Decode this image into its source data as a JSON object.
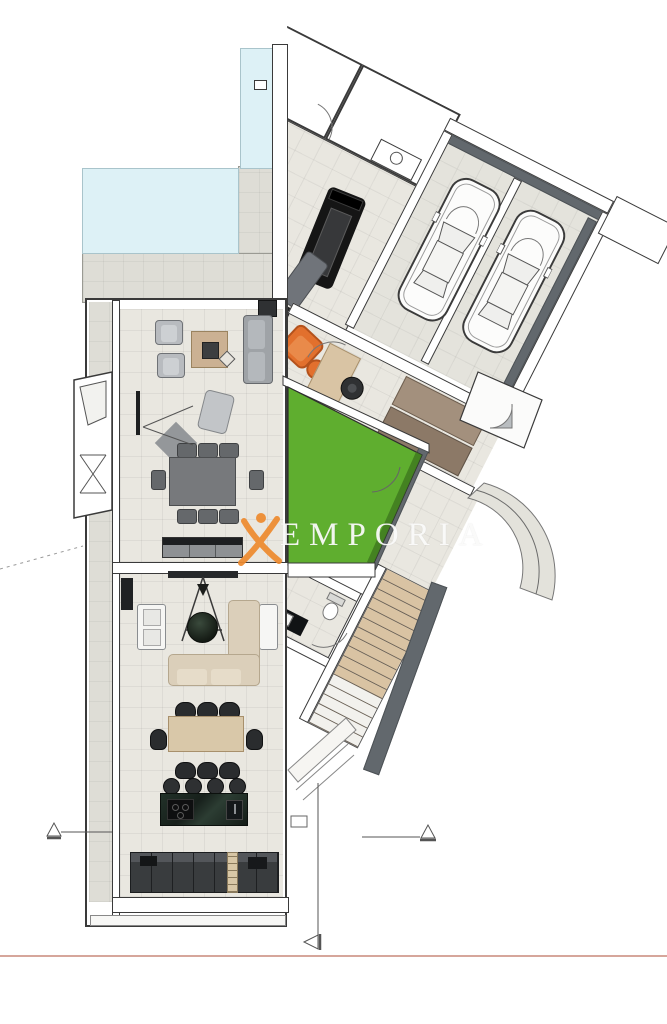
{
  "watermark": {
    "text": "EMPORIA",
    "logo": "x-figure-icon",
    "logo_color": "#EE8A2E",
    "text_color": "rgba(252,252,251,0.93)"
  },
  "palette": {
    "background": "#FFFFFF",
    "pool_water": "#DDF1F6",
    "lawn_green": "#5FAE2F",
    "lawn_edge_dark": "#3F7A1E",
    "floor_tile": "#E9E7E0",
    "terrace_grey": "#DEDDD6",
    "wall_white": "#FFFFFF",
    "wall_outline": "#3A3A3A",
    "wall_shadow_grey": "#62686D",
    "stair_tread_tan": "#D9C3A3",
    "accent_orange": "#E2702D",
    "kitchen_cabinet_dark": "#3C3F41",
    "island_marble_dark": "#1C2620",
    "sofa_beige": "#DBCFBA",
    "sofa_grey": "#9FA3A7",
    "wood_tan": "#CBB193",
    "setback_line_salmon": "#C9897A"
  },
  "counts": {
    "garage_cars": 2,
    "upper_dining_chairs": 8,
    "lower_dining_chairs": 8,
    "kitchen_bar_stools": 4,
    "stair_treads": 16,
    "kitchen_cabinet_doors": 7
  }
}
